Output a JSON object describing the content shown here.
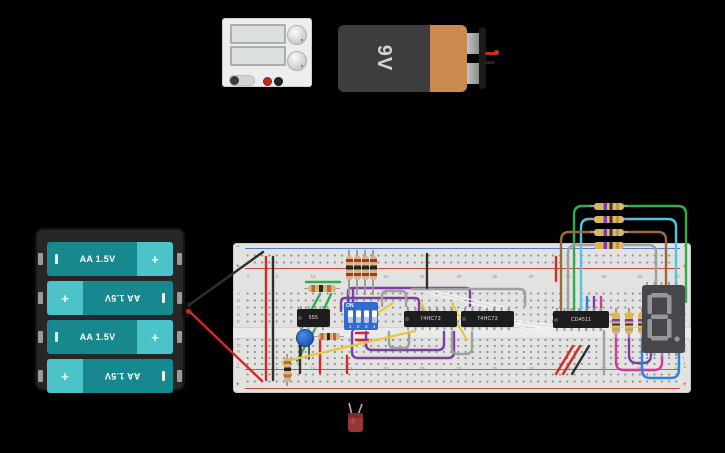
{
  "colors": {
    "background": "#000000",
    "breadboard": "#e2e2e0",
    "ic_body": "#1d1d1f",
    "dip_blue": "#2f6cd0",
    "battery_teal": "#17898e",
    "battery_teal_light": "#4cc3c9",
    "battery9v_dark": "#3d3d3f",
    "battery9v_orange": "#c9894f",
    "wire_red": "#d62828",
    "wire_black": "#2e2e2e",
    "wire_green": "#2fae4a",
    "wire_purple": "#7b3fa0",
    "wire_gray": "#a0a0a0",
    "wire_yellow": "#e6c83c",
    "wire_white": "#f4f4f4",
    "wire_cyan": "#56c3de",
    "wire_brown": "#9a6a3a",
    "wire_magenta": "#d6369b",
    "wire_blue": "#2a85d8",
    "led_red": "#963636"
  },
  "battery_9v": {
    "label": "9V"
  },
  "battery_pack": {
    "cells": [
      {
        "label": "AA 1.5V",
        "plus": "+",
        "flipped": false
      },
      {
        "label": "AA 1.5V",
        "plus": "+",
        "flipped": true
      },
      {
        "label": "AA 1.5V",
        "plus": "+",
        "flipped": false
      },
      {
        "label": "AA 1.5V",
        "plus": "+",
        "flipped": true
      }
    ]
  },
  "ics": {
    "timer_label": "555",
    "flipflop1_label": "74HC73",
    "flipflop2_label": "74HC73",
    "decoder_label": "CD4511"
  },
  "dip_switch": {
    "on_label": "ON",
    "positions": [
      "1",
      "2",
      "3",
      "4"
    ]
  },
  "seven_segment": {
    "shown_value": "8."
  },
  "breadboard": {
    "rows_top": [
      "A",
      "B",
      "C",
      "D",
      "E"
    ],
    "rows_bottom": [
      "F",
      "G",
      "H",
      "I",
      "J"
    ],
    "columns": [
      "1",
      "5",
      "10",
      "15",
      "20",
      "25",
      "30",
      "35",
      "40",
      "45",
      "50",
      "55",
      "60"
    ],
    "plus": "+",
    "minus": "−"
  }
}
